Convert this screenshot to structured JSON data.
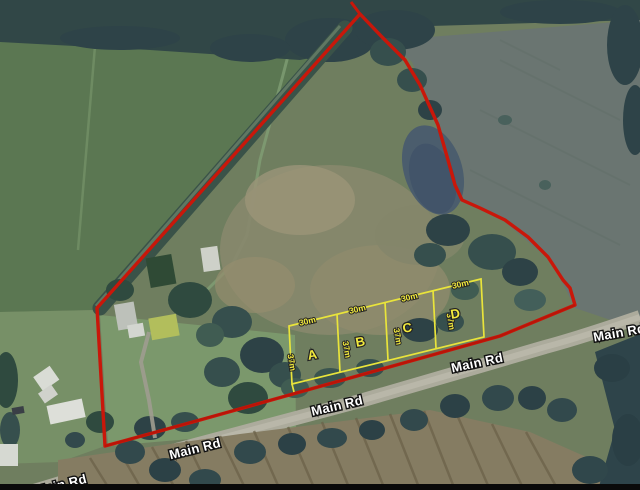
{
  "map": {
    "road_labels": [
      {
        "text": "Main Rd"
      },
      {
        "text": "Main Rd"
      },
      {
        "text": "Main Rd"
      },
      {
        "text": "Main Rd"
      },
      {
        "text": "Main Rd"
      }
    ],
    "plots": [
      {
        "letter": "A",
        "frontage": "30m",
        "depth": "37m"
      },
      {
        "letter": "B",
        "frontage": "30m",
        "depth": "37m"
      },
      {
        "letter": "C",
        "frontage": "30m",
        "depth": "37m"
      },
      {
        "letter": "D",
        "frontage": "37m",
        "depth": "37m"
      }
    ],
    "plot_frontage": "30m",
    "colors": {
      "boundary_red": "#c9170a",
      "plot_yellow": "#e9e43b",
      "label_yellow": "#f2ea3e",
      "road_label_white": "#ffffff"
    }
  }
}
